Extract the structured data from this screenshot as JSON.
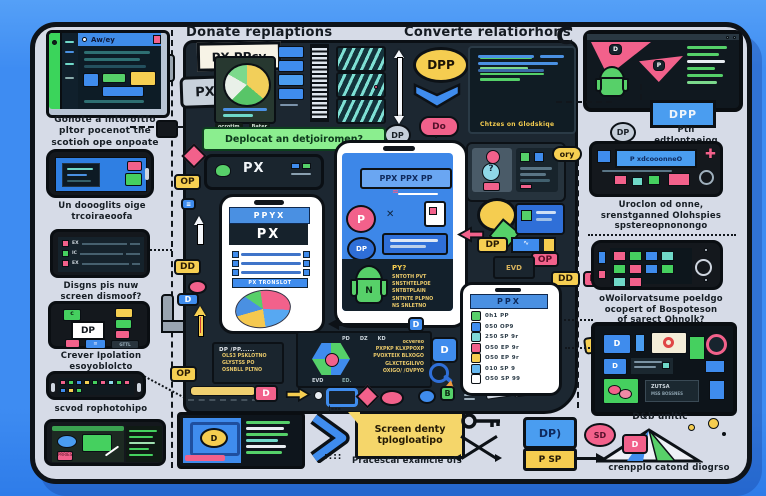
{
  "headings": {
    "left": "Donate replaptions",
    "right": "Converte relatiorhons"
  },
  "left_column": {
    "browser_title": "Aw/ey",
    "caption1": [
      "Gonote a intoroftfo",
      "pltor pocenot the",
      "scotioh ope onpoate"
    ],
    "caption2": [
      "Un doooglits oige",
      "trcoiraeoofa"
    ],
    "caption3": [
      "Disgns pis nuw",
      "screen dismoof?"
    ],
    "caption4": [
      "Crever Ipolation",
      "esoyoblolcto"
    ],
    "caption5": "scvod rophotohipo",
    "dp_label": "DP",
    "phone4_c": "c",
    "phone4_g": "GTTL",
    "phone3_rows": [
      "EX",
      "IC",
      "EX"
    ],
    "phone6_chip": "PRRIES"
  },
  "center": {
    "sign": "PX PPcy",
    "px_badge": "PX",
    "pie_label_a": "ocrotim",
    "pie_label_b": "Bater",
    "dp_circle": "DP",
    "banner": "Deplocat an detjoiromen?",
    "titlebar": "PX",
    "main_phone": {
      "header": "PPYX",
      "bar": "PX",
      "row4": "PX TRONSLOT"
    },
    "dpp": "DPP",
    "do_pill": "Do",
    "code_caption": "Chtzes on Glodskiqe",
    "phone2": {
      "label": "PPX PPX PP",
      "p": "P",
      "dp": "DP",
      "robot_n": "N",
      "code_title": "PY?",
      "code_lines": [
        "SNTOTH PVT",
        "SNSTHTELPOE",
        "SNTBTPLAIN",
        "SNTNTE PLPNO",
        "NS SNLETNO"
      ]
    },
    "chips": {
      "op_top": "OP",
      "dd_left": "DD",
      "d_left": "D",
      "op_bottom": "OP",
      "dp_right": "DP",
      "op_pink": "OP",
      "evb": "EVD",
      "dd_right": "DD",
      "p_right": "P",
      "ory": "ory",
      "nine_p": "9P",
      "dp_grey2": "DP"
    },
    "ppx_phone": {
      "header": "PPX",
      "rows": [
        {
          "text": "0h1 PP"
        },
        {
          "text": "050 OP9"
        },
        {
          "text": "250 SP 9r"
        },
        {
          "text": "O50 EP 9r"
        },
        {
          "text": "O50 EP 9r"
        },
        {
          "text": "010 SP 9"
        },
        {
          "text": "O50 SP 99"
        }
      ]
    },
    "code_left": {
      "title": "DP /PP......",
      "lines": [
        "OLS3 PSKLOTNO",
        "GLYSTSS PO",
        "OSNBLL PLTNO"
      ]
    },
    "code_right": {
      "chips": [
        "PD",
        "DZ",
        "KD"
      ],
      "chip2": "EVD",
      "lines": [
        "ocvereo",
        "PXPKP KLXPPOXP",
        "PVOXTEIX BLXOGO",
        "GLXCTEGILIVO",
        "OXIGO/ /OVPYO"
      ],
      "foot": "ED."
    },
    "d_tag": "D",
    "d_button": "D"
  },
  "right_column": {
    "c_glyph": "C",
    "mon_d": "D",
    "mon_p": "P",
    "dpp_tag": "DPP",
    "caption1": [
      "Ptn",
      "edtloptaeiog"
    ],
    "r2_text": "P xdcooonneO",
    "caption2": [
      "Uroclon od onne,",
      "srenstganned Olohspies",
      "spstereopnonongo"
    ],
    "caption3": [
      "oWoilorvatsume poeldgo",
      "ocopert of Bospoteson",
      "of sarect Qhnolk?"
    ],
    "tablet_t1": "ZUTSA",
    "tablet_t2": "MSS BOSSNES",
    "caption4": "D&b unltic",
    "caption5": "crenpplo catond diogrso"
  },
  "bottom": {
    "note": [
      "Screen denty",
      "tplogloatipo"
    ],
    "caption": "Pracescal examcie ofs",
    "dp": "DP)",
    "psp": "P SP",
    "sd": "SD",
    "d": "D"
  },
  "icons": {
    "x_mark": "✕",
    "question_mark": "?",
    "plus": "✚",
    "dots": "¦---",
    "colon_dots": "::::"
  }
}
